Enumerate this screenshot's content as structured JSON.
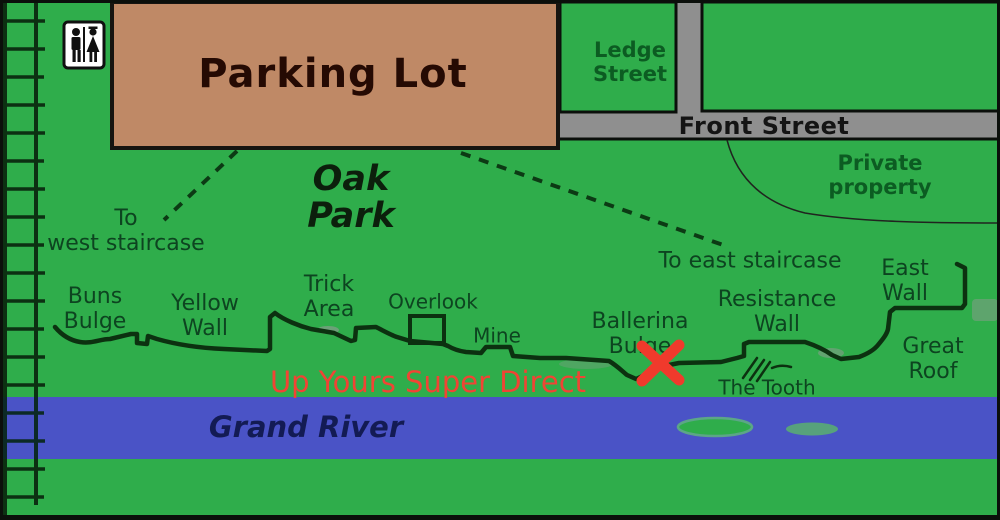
{
  "map": {
    "title": "Oak Park climbing area map",
    "colors": {
      "field_green": "#2fad4b",
      "road_gray": "#8f8f8f",
      "river_blue": "#4a53c6",
      "parking_brown": "#bf8966",
      "cliff_line_dark": "#0d3512",
      "label_green": "#0d4420",
      "route_red": "#f03a2c",
      "river_text_navy": "#131b54"
    },
    "icons": [
      {
        "name": "restroom-icon",
        "meaning": "restrooms (men/women)"
      }
    ],
    "route_marker": {
      "shape": "red-x",
      "route": "Up Yours Super Direct"
    }
  },
  "labels": [
    {
      "id": "parking-lot",
      "text": "Parking Lot",
      "x": 333,
      "y": 74,
      "cls": "parking"
    },
    {
      "id": "ledge-street",
      "text": "Ledge\nStreet",
      "x": 630,
      "y": 62,
      "cls": "street-green"
    },
    {
      "id": "front-street",
      "text": "Front Street",
      "x": 764,
      "y": 126,
      "cls": "street-black"
    },
    {
      "id": "private-property",
      "text": "Private\nproperty",
      "x": 880,
      "y": 175,
      "cls": "street-green"
    },
    {
      "id": "oak-park",
      "text": "Oak\nPark",
      "x": 351,
      "y": 198,
      "cls": "park-title"
    },
    {
      "id": "to-west-staircase",
      "text": "To\nwest staircase",
      "x": 126,
      "y": 231,
      "cls": "place"
    },
    {
      "id": "to-east-staircase",
      "text": "To east staircase",
      "x": 750,
      "y": 261,
      "cls": "place"
    },
    {
      "id": "buns-bulge",
      "text": "Buns\nBulge",
      "x": 95,
      "y": 309,
      "cls": "place"
    },
    {
      "id": "yellow-wall",
      "text": "Yellow\nWall",
      "x": 205,
      "y": 316,
      "cls": "place"
    },
    {
      "id": "trick-area",
      "text": "Trick\nArea",
      "x": 329,
      "y": 297,
      "cls": "place"
    },
    {
      "id": "overlook",
      "text": "Overlook",
      "x": 433,
      "y": 302,
      "cls": "place-sm"
    },
    {
      "id": "mine",
      "text": "Mine",
      "x": 497,
      "y": 336,
      "cls": "place-sm"
    },
    {
      "id": "ballerina-bulge",
      "text": "Ballerina\nBulge",
      "x": 640,
      "y": 334,
      "cls": "place"
    },
    {
      "id": "resistance-wall",
      "text": "Resistance\nWall",
      "x": 777,
      "y": 312,
      "cls": "place"
    },
    {
      "id": "east-wall",
      "text": "East Wall",
      "x": 905,
      "y": 281,
      "cls": "place"
    },
    {
      "id": "great-roof",
      "text": "Great\nRoof",
      "x": 933,
      "y": 359,
      "cls": "place"
    },
    {
      "id": "the-tooth",
      "text": "The Tooth",
      "x": 767,
      "y": 388,
      "cls": "place-sm"
    },
    {
      "id": "grand-river",
      "text": "Grand River",
      "x": 306,
      "y": 427,
      "cls": "river-name"
    },
    {
      "id": "route-up-yours-super-direct",
      "text": "Up Yours Super Direct",
      "x": 428,
      "y": 382,
      "cls": "route-red"
    }
  ]
}
